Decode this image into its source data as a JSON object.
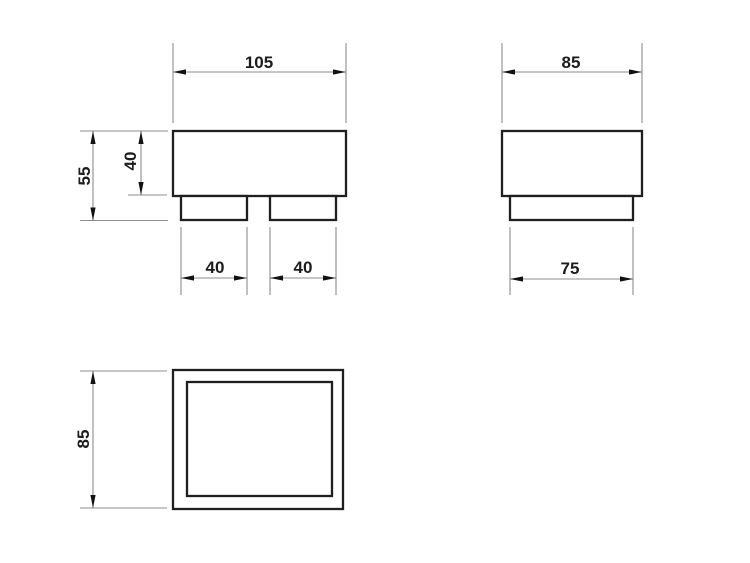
{
  "drawing": {
    "type": "technical-orthographic-views",
    "colors": {
      "background": "#ffffff",
      "object_line": "#1f1f1f",
      "dimension_line": "#8c8c8c",
      "arrow": "#111111",
      "text": "#1c1c1c"
    },
    "views": {
      "front": {
        "dimensions": {
          "overall_width": "105",
          "overall_height": "55",
          "body_height": "40",
          "left_foot_width": "40",
          "right_foot_width": "40"
        }
      },
      "side": {
        "dimensions": {
          "overall_width": "85",
          "foot_width": "75"
        }
      },
      "top": {
        "dimensions": {
          "overall_depth": "85"
        }
      }
    }
  }
}
